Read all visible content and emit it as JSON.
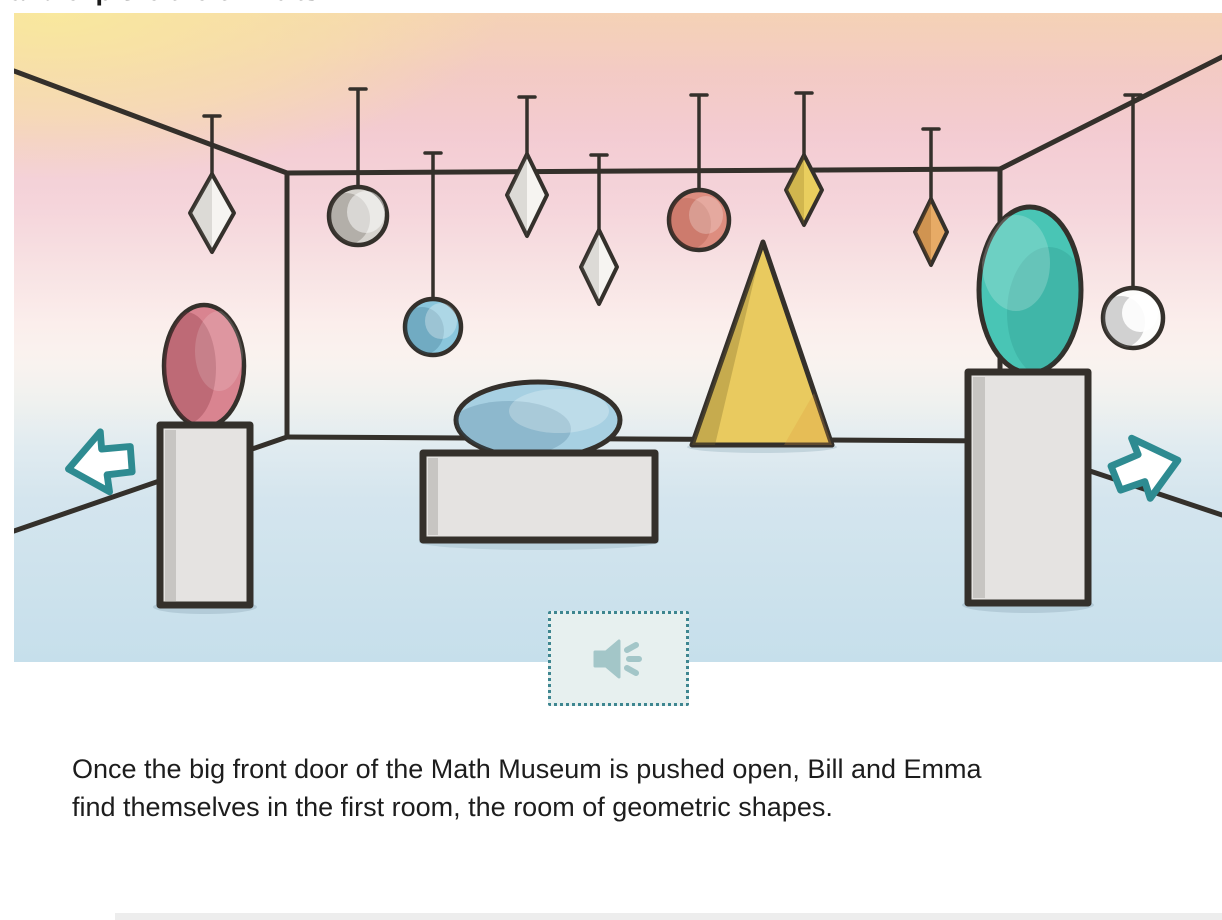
{
  "page": {
    "top_clipped_text": "and explore the exhibits.",
    "story_lines": [
      "Once the big front door of the Math Museum is pushed open, Bill and Emma",
      "find themselves in the first room, the room of geometric shapes."
    ]
  },
  "illustration": {
    "scene": "watercolor room of the Math Museum",
    "hanging_shapes": [
      "white diamond",
      "gray circle",
      "blue circle",
      "white diamond",
      "white diamond",
      "coral circle",
      "yellow diamond",
      "orange diamond",
      "white circle"
    ],
    "standing_shapes": [
      "pink oval on tall pedestal",
      "blue oval on low block",
      "yellow triangle",
      "teal oval on tall pedestal"
    ]
  },
  "controls": {
    "prev_button_icon": "arrow-left",
    "next_button_icon": "arrow-right",
    "audio_button_icon": "speaker"
  },
  "colors": {
    "outline": "#34302b",
    "arrow_teal": "#2e8b91",
    "audio_border": "#3e8690",
    "audio_bg": "#e7f0ef",
    "audio_icon": "#a3c6c8",
    "shape_white": "#f6f4f1",
    "gray_ball": "#d7d4cf",
    "blue_ball": "#8ac6dc",
    "coral_ball": "#dd8d7f",
    "white_ball": "#fdfdfc",
    "red_ellipse": "#d98490",
    "blue_ellipse": "#a7d0e2",
    "teal_ellipse": "#49c5b5",
    "yellow_triangle": "#e9ca5f",
    "yellow_diamond": "#e9ce5e",
    "orange_diamond": "#e7ab66",
    "pedestal_gray": "#e5e3e1",
    "story_text": "#1d1d1d"
  }
}
